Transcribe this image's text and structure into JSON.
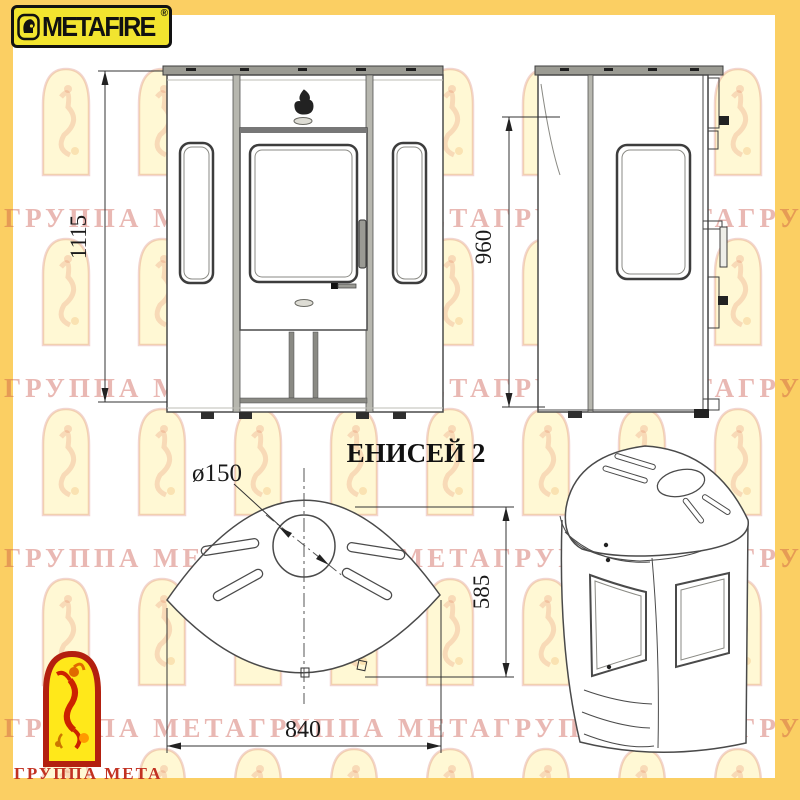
{
  "brand": {
    "name": "METAFIRE",
    "registered": "®",
    "icon": "knight-helmet-icon"
  },
  "title": "ЕНИСЕЙ 2",
  "dimensions": {
    "front_height_mm": "1115",
    "side_height_mm": "960",
    "flue_diameter": "ø150",
    "depth_mm": "585",
    "width_mm": "840"
  },
  "watermark": {
    "row_text": "ГРУППА МЕТАГРУППА МЕТАГРУППА МЕТАГРУППА МЕТА"
  },
  "footer_logo": {
    "label": "ГРУППА МЕТА",
    "icon": "dancing-jester-arch-icon"
  },
  "colors": {
    "frame_yellow": "#fbcf63",
    "badge_yellow": "#f2e42f",
    "logo_red": "#c23222",
    "drawing_line": "#4a4a4a"
  }
}
